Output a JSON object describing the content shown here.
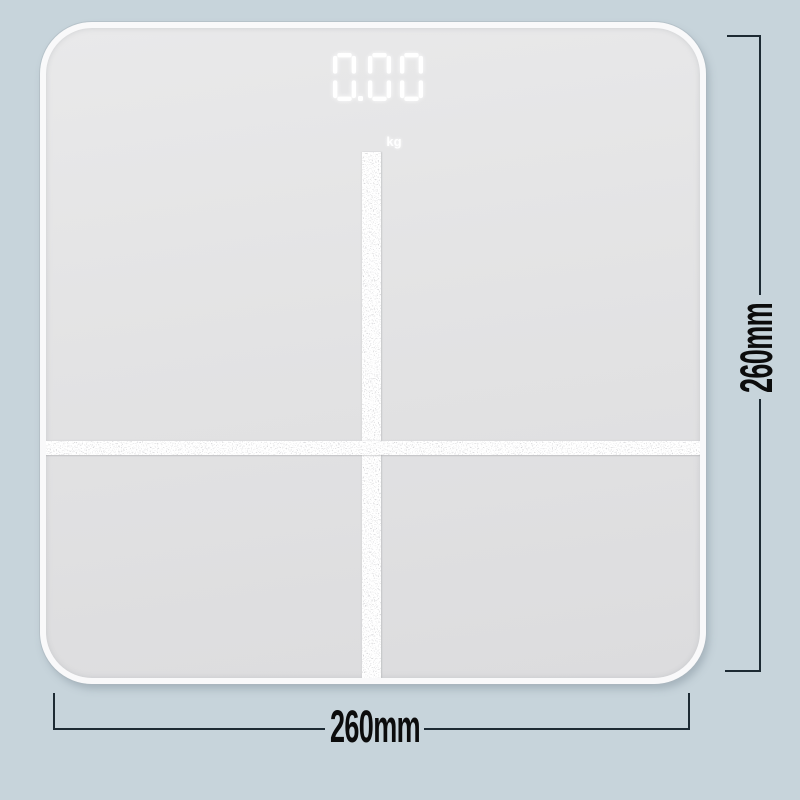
{
  "background_color": "#c7d4db",
  "scale": {
    "surface_color": "#e3e3e4",
    "surface_light": "#e9e9ea",
    "surface_dark": "#dcdcde",
    "display": {
      "value": "0.00",
      "unit": "kg",
      "led_color": "#ffffff"
    }
  },
  "dimensions": {
    "width_label": "260mm",
    "height_label": "260mm",
    "line_color": "#1d2a33",
    "text_color": "#0c0c0c"
  }
}
